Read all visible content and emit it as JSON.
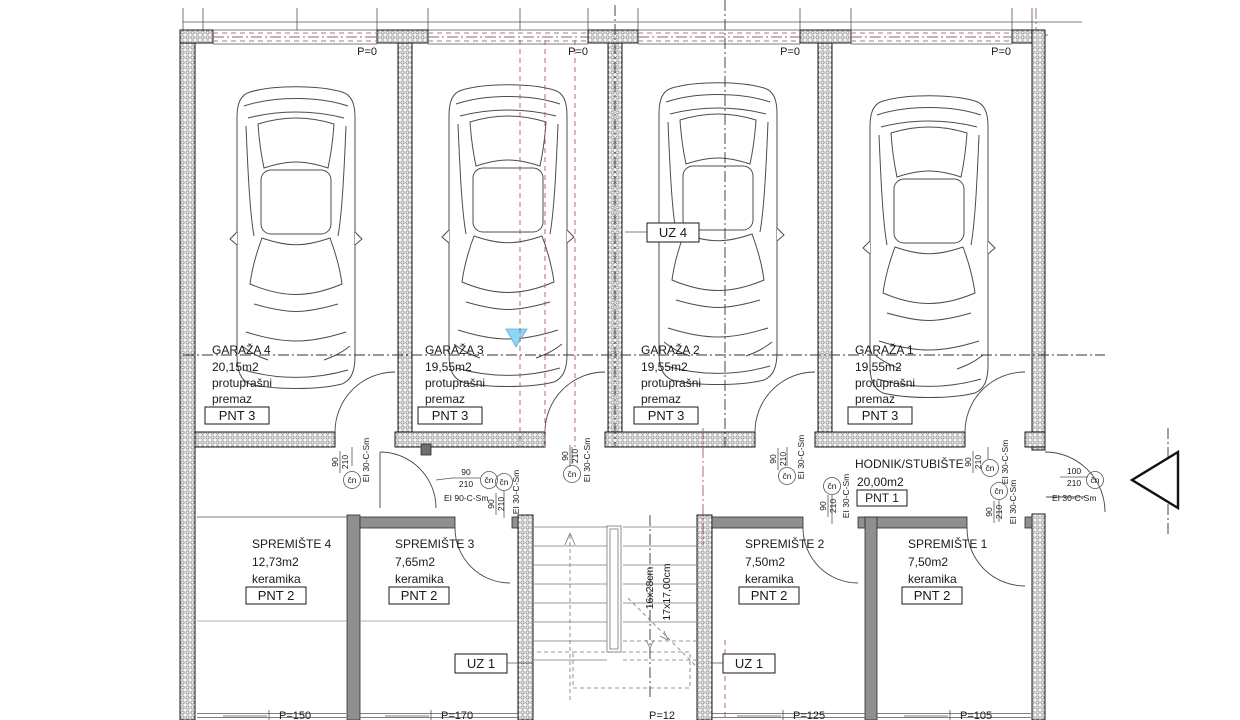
{
  "drawing": {
    "rooms": {
      "garaza4": {
        "name": "GARAŽA 4",
        "area": "20,15m2",
        "finish_line1": "protuprašni",
        "finish_line2": "premaz",
        "panel": "PNT 3"
      },
      "garaza3": {
        "name": "GARAŽA 3",
        "area": "19,55m2",
        "finish_line1": "protuprašni",
        "finish_line2": "premaz",
        "panel": "PNT 3"
      },
      "garaza2": {
        "name": "GARAŽA 2",
        "area": "19,55m2",
        "finish_line1": "protuprašni",
        "finish_line2": "premaz",
        "panel": "PNT 3"
      },
      "garaza1": {
        "name": "GARAŽA 1",
        "area": "19,55m2",
        "finish_line1": "protuprašni",
        "finish_line2": "premaz",
        "panel": "PNT 3"
      },
      "hodnik": {
        "name": "HODNIK/STUBIŠTE",
        "area": "20,00m2",
        "panel": "PNT 1"
      },
      "spremiste4": {
        "name": "SPREMIŠTE 4",
        "area": "12,73m2",
        "finish": "keramika",
        "panel": "PNT 2"
      },
      "spremiste3": {
        "name": "SPREMIŠTE 3",
        "area": "7,65m2",
        "finish": "keramika",
        "panel": "PNT 2"
      },
      "spremiste2": {
        "name": "SPREMIŠTE 2",
        "area": "7,50m2",
        "finish": "keramika",
        "panel": "PNT 2"
      },
      "spremiste1": {
        "name": "SPREMIŠTE 1",
        "area": "7,50m2",
        "finish": "keramika",
        "panel": "PNT 2"
      }
    },
    "levels": {
      "top": "P=0",
      "sp4": "P=150",
      "sp3": "P=170",
      "stair": "P=12",
      "sp2": "P=125",
      "sp1": "P=105"
    },
    "markers": {
      "uz4": "UZ 4",
      "uz1": "UZ 1"
    },
    "stairs": {
      "treads": "16x28cm",
      "risers": "17x17,00cm"
    },
    "doors": {
      "w90": "90",
      "h210": "210",
      "w100": "100",
      "cn": "čn",
      "ei30": "EI 30-C-Sm",
      "ei90": "EI 90-C-Sm"
    },
    "colors": {
      "axis_magenta": "#a85a6e",
      "annotation_blue": "#8fd4f2"
    }
  }
}
